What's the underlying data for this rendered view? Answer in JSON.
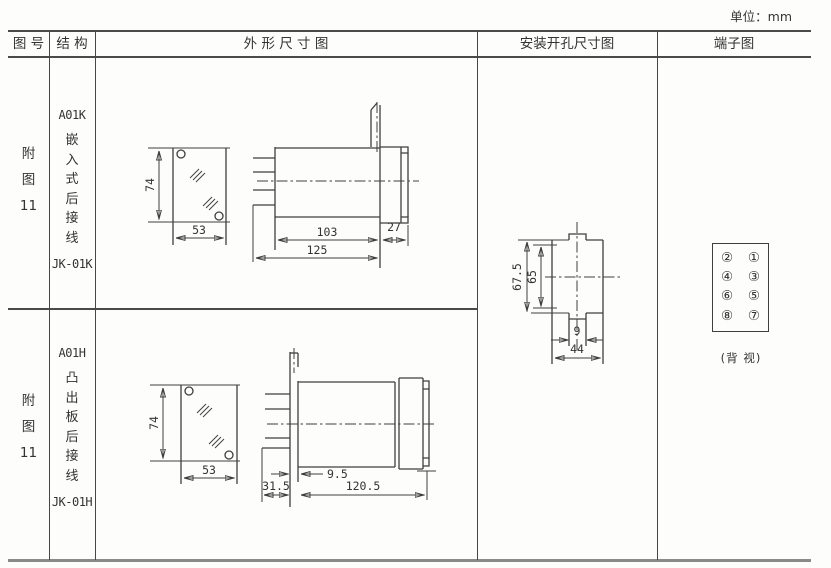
{
  "page": {
    "unit_label": "单位：mm"
  },
  "header": {
    "figure_no": "图 号",
    "structure": "结 构",
    "outline": "外 形 尺 寸 图",
    "mounting": "安装开孔尺寸图",
    "terminal": "端子图"
  },
  "rows": [
    {
      "figure_lines": [
        "附",
        "图",
        "11"
      ],
      "model_top": "A01K",
      "structure_chars": [
        "嵌",
        "入",
        "式",
        "后",
        "接",
        "线"
      ],
      "model_bottom": "JK-01K",
      "dims": {
        "front_height": "74",
        "front_width": "53",
        "body_length": "103",
        "bezel_depth": "27",
        "total_length": "125"
      }
    },
    {
      "figure_lines": [
        "附",
        "图",
        "11"
      ],
      "model_top": "A01H",
      "structure_chars": [
        "凸",
        "出",
        "板",
        "后",
        "接",
        "线"
      ],
      "model_bottom": "JK-01H",
      "dims": {
        "front_height": "74",
        "front_width": "53",
        "panel_offset": "9.5",
        "rear_depth": "31.5",
        "front_length": "120.5"
      }
    }
  ],
  "mounting": {
    "outer_height": "67.5",
    "inner_height": "65",
    "notch_width": "9",
    "cutout_width": "44"
  },
  "terminal": {
    "pins": [
      [
        "②",
        "①"
      ],
      [
        "④",
        "③"
      ],
      [
        "⑥",
        "⑤"
      ],
      [
        "⑧",
        "⑦"
      ]
    ],
    "caption": "(背 视)"
  }
}
